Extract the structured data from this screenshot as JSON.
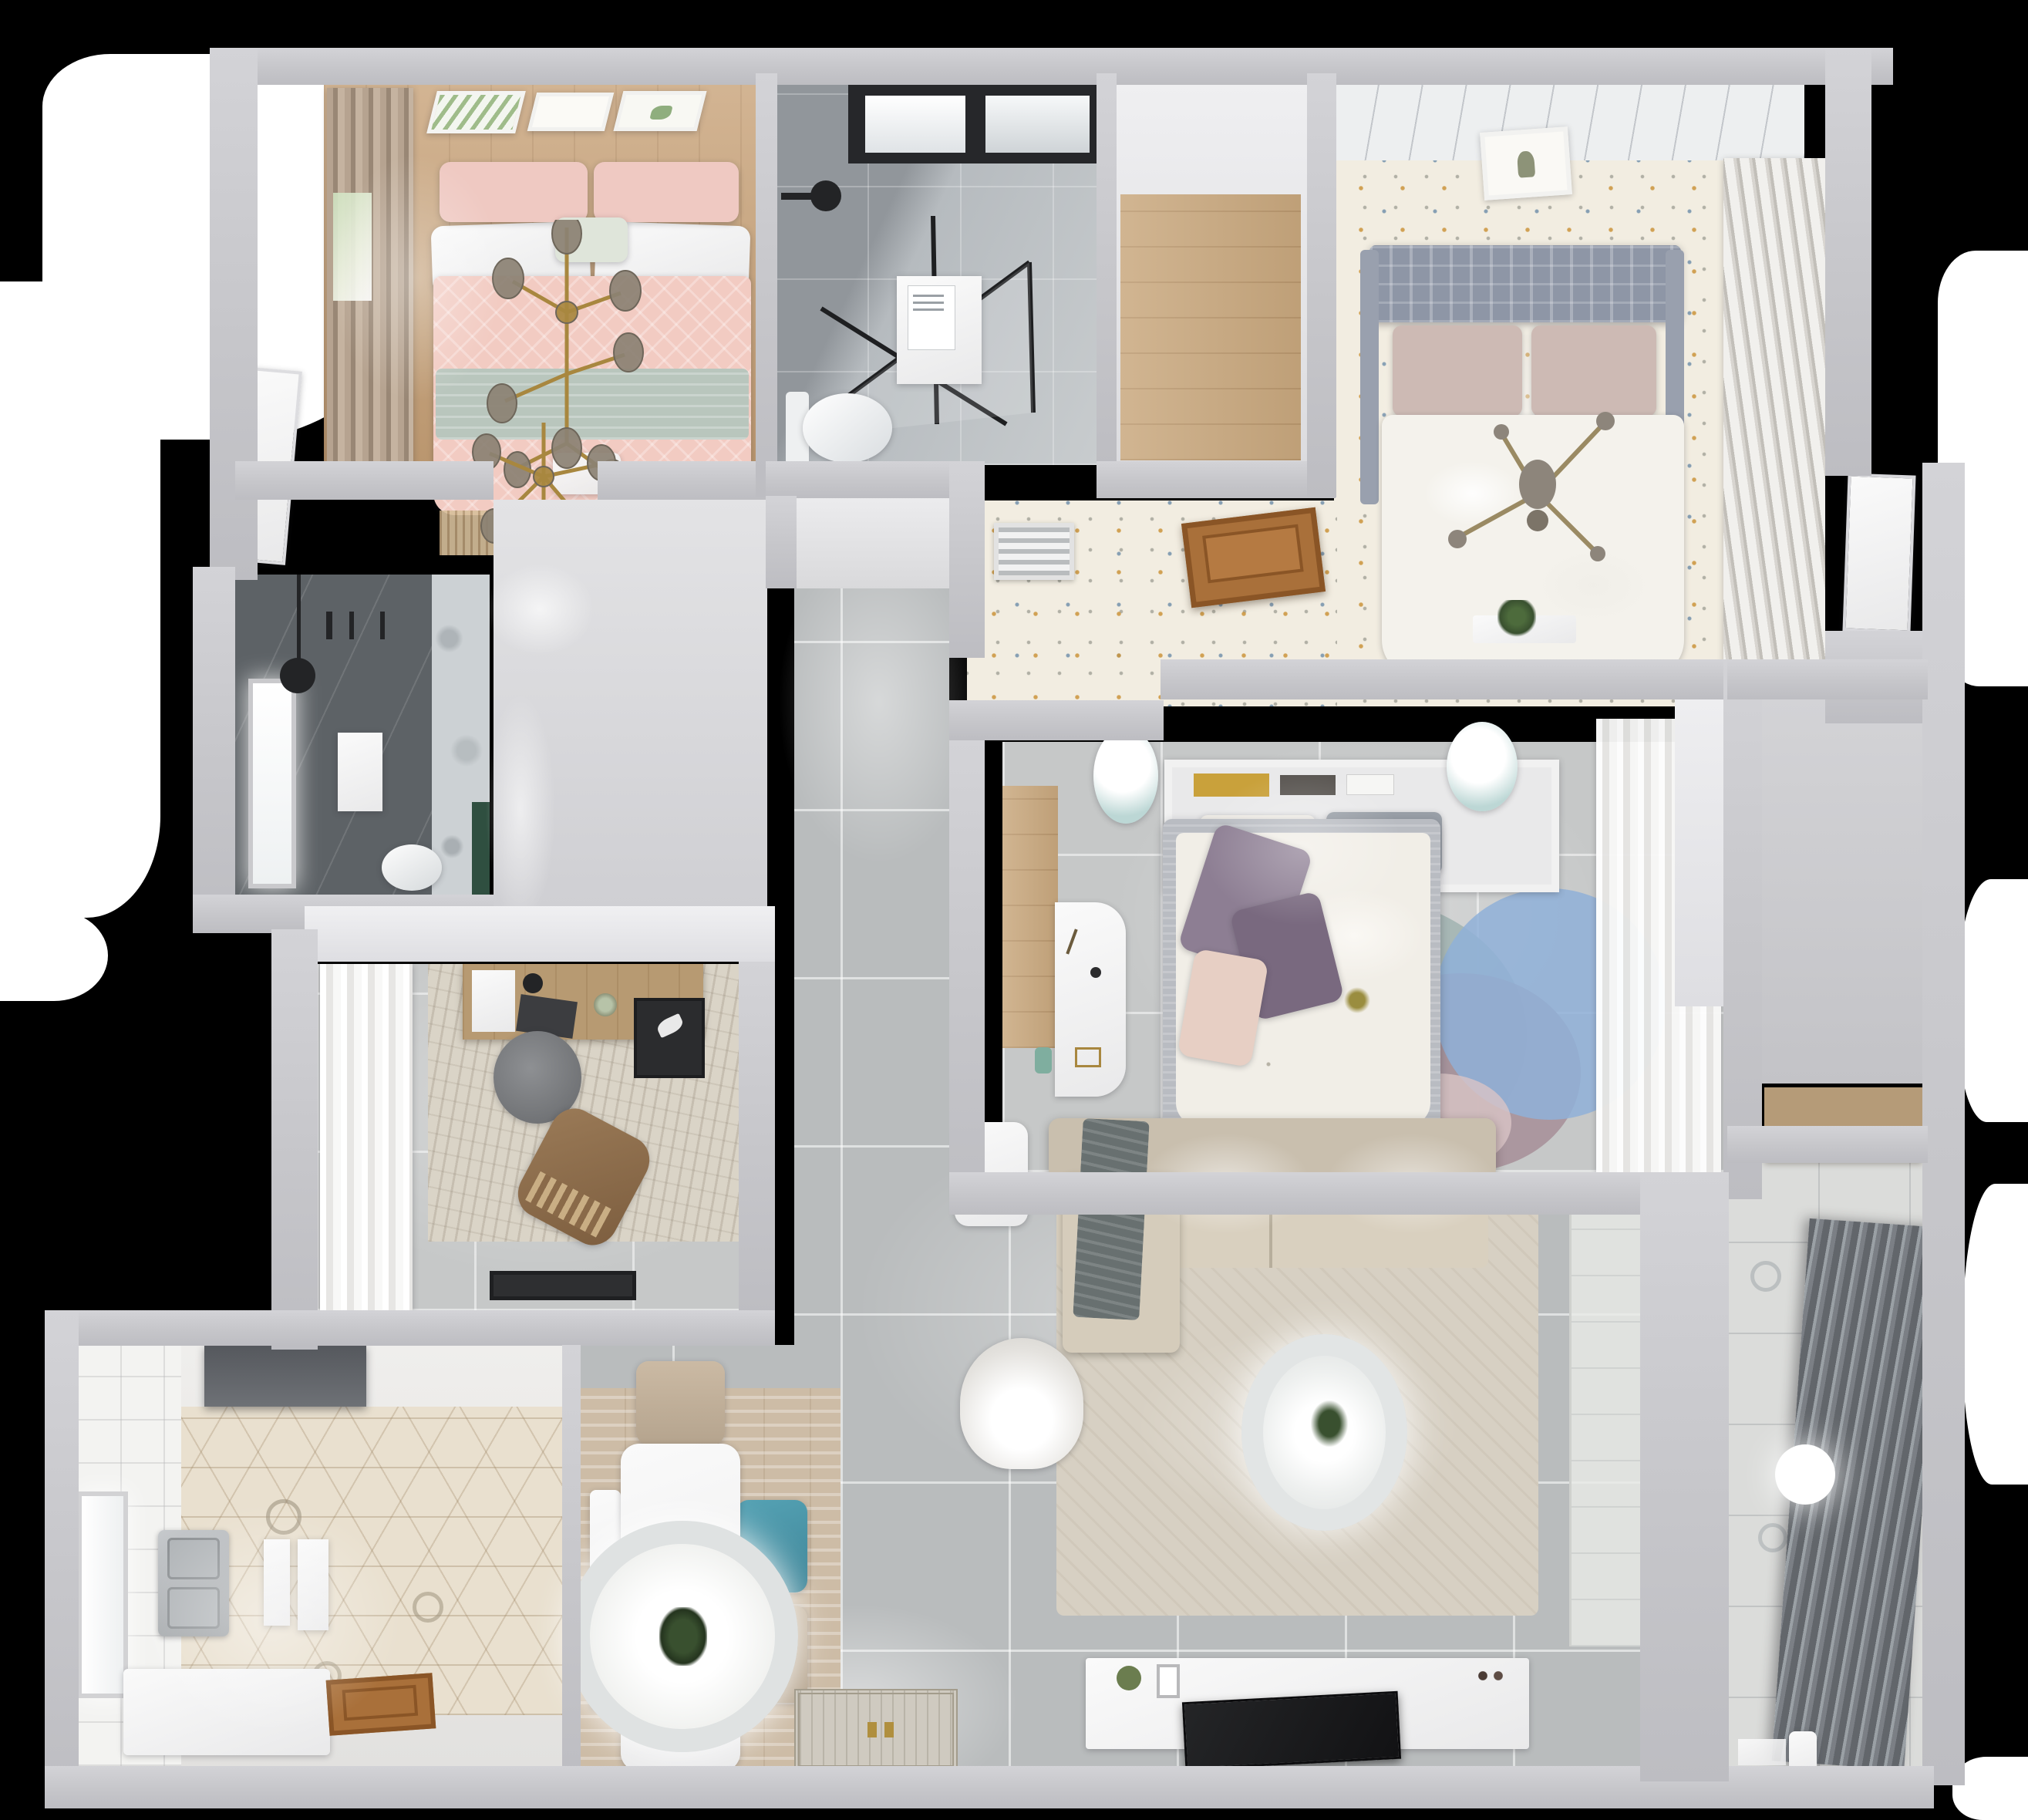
{
  "scene": {
    "title": "Top-down 3D render of a furnished apartment floor plan",
    "type": "floor-plan-3d-render",
    "view": "overhead dollhouse",
    "background": "#000000"
  },
  "palette": {
    "backdrop": "#000000",
    "light_spill": "#ffffff",
    "wall": "#c6c6ca",
    "wall_lit": "#e8e8ea",
    "tile_floor": "#b9bcbd",
    "tile_grout": "#d6d8d9",
    "hall_floor": "#d8d8da",
    "wood_warm": "#c69f74",
    "wood_closet": "#c9a87e",
    "hatch_wood": "#a9703a",
    "floral_floor": "#f2ede1",
    "hex_tile": "#e9e0cf",
    "marble_dark": "#969ba0",
    "marble_light": "#c2c6c9",
    "dark_tile": "#5d6266",
    "pink_bedding": "#f2cbc2",
    "sage_throw": "#b9c6bd",
    "soft_white": "#f3f1ec",
    "gray_headboard": "#8e96a6",
    "purple_pillow": "#8d7e93",
    "blush_pillow": "#e7cfc4",
    "teal_chair": "#4a96a9",
    "rug_blue": "#8fb0d8",
    "rug_mauve": "#a78f98",
    "rug_teal": "#a3b5b2",
    "sofa_beige": "#d6ccbb",
    "brown_chair": "#8a6a49",
    "gold_accent": "#a8873f",
    "black_fixture": "#232426",
    "green_plant": "#39502f",
    "green_tile": "#2f4f40",
    "balcony_rack": "#6e7276"
  },
  "rooms": [
    {
      "id": "master-bedroom",
      "name": "Master bedroom",
      "furniture": [
        "three botanical wall art frames",
        "taupe curtains",
        "window",
        "double bed with pink patterned bedding",
        "sage throw band",
        "gold branch chandeliers",
        "foot bench",
        "fringe rug",
        "white door"
      ]
    },
    {
      "id": "bathroom-north",
      "name": "North bathroom",
      "furniture": [
        "black framed window",
        "rain shower head",
        "black framed glass shower enclosure",
        "storage unit",
        "toilet"
      ]
    },
    {
      "id": "walk-in-closet",
      "name": "Walk-in closet",
      "furniture": [
        "laminate wood floor"
      ]
    },
    {
      "id": "bedroom-east",
      "name": "East bedroom",
      "furniture": [
        "plank ceiling band",
        "wall art",
        "gray tufted headboard bed",
        "blush pillows",
        "cross chandelier",
        "speckled floral floor",
        "louvered wardrobe",
        "wood floor hatch",
        "air vent grille",
        "plant on ledge",
        "white door"
      ]
    },
    {
      "id": "bedroom-center",
      "name": "Center bedroom",
      "furniture": [
        "headboard shelf with books",
        "two bedside stools",
        "double bed with purple pillows",
        "overlapping circle rug",
        "white desk",
        "sheer-front wardrobe",
        "wood floor strip"
      ]
    },
    {
      "id": "bathroom-west",
      "name": "West bathroom",
      "furniture": [
        "bright window",
        "black pendant lamp",
        "towel sheet",
        "toilet",
        "green accent tiles",
        "shower fittings"
      ]
    },
    {
      "id": "study",
      "name": "Study",
      "furniture": [
        "sheer curtains",
        "distressed area rug",
        "wood writing desk",
        "laptop",
        "desk lamp",
        "papers",
        "gray swivel chair",
        "brown lounge chair",
        "dark wall rack",
        "black floor mat"
      ]
    },
    {
      "id": "kitchen",
      "name": "Kitchen",
      "furniture": [
        "tall dark unit with hood",
        "hexagon tile floor",
        "window",
        "stainless double sink",
        "hanging towels",
        "white counter",
        "wood entry door"
      ]
    },
    {
      "id": "dining",
      "name": "Dining area",
      "furniture": [
        "wood-tone area rug",
        "white dining table",
        "round pendant lamp with plant centerpiece",
        "beige chair",
        "teal chair",
        "second beige chair",
        "white bench"
      ]
    },
    {
      "id": "living",
      "name": "Living room",
      "furniture": [
        "beige sectional sofa",
        "gray throw blanket",
        "large area rug",
        "round ceiling lamp with plant",
        "round armchair",
        "side table",
        "tv console with decor",
        "flat tv",
        "ornate entry mat"
      ]
    },
    {
      "id": "balcony",
      "name": "Balcony",
      "furniture": [
        "patterned tile floor",
        "slatted drying rack",
        "white ball pendant light",
        "toy cart",
        "water jug",
        "small tray",
        "glass partition"
      ]
    },
    {
      "id": "hallways",
      "name": "Hallways",
      "furniture": [
        "gray tile corridor",
        "master hall",
        "east hall wood counter",
        "entry zone"
      ]
    }
  ]
}
